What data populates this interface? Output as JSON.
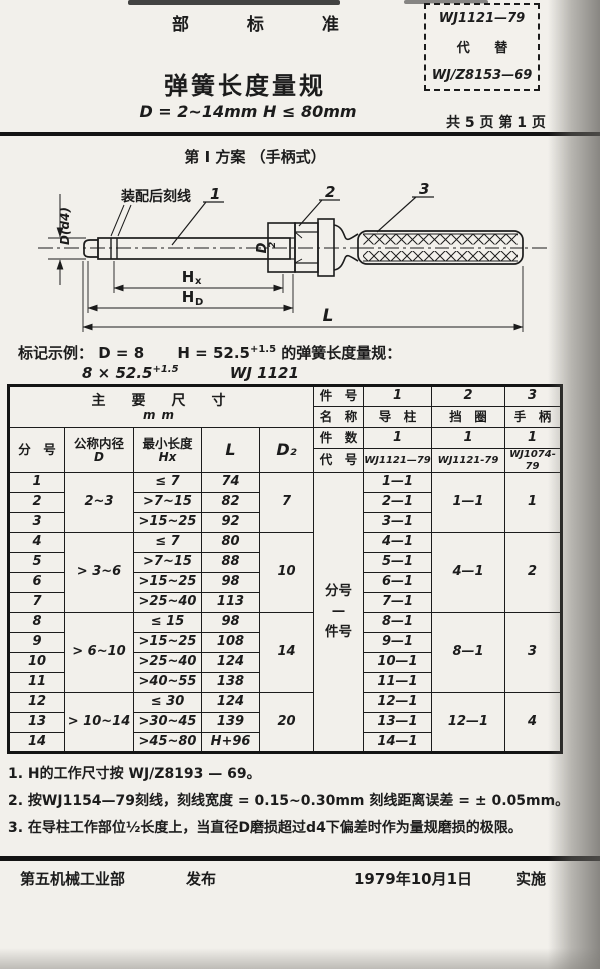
{
  "header": {
    "standard_type": "部 标 准",
    "code_box": {
      "line1": "WJ1121—79",
      "line2": "代 替",
      "line3": "WJ/Z8153—69"
    },
    "title": "弹簧长度量规",
    "spec_line": "D = 2~14mm   H ≤ 80mm",
    "page_info": "共 5 页 第 1 页"
  },
  "scheme_heading": "第 I 方案   （手柄式）",
  "drawing": {
    "scribe_callout": "装配后刻线",
    "part_labels": [
      "1",
      "2",
      "3"
    ],
    "dim_d": "D(d4)",
    "dim_d2_base": "D",
    "dim_d2_sub": "2",
    "dim_hx_base": "H",
    "dim_hx_sub": "x",
    "dim_hd_base": "H",
    "dim_hd_sub": "D",
    "dim_l": "L"
  },
  "marking": {
    "label": "标记示例：",
    "d": "D = 8",
    "h": "H = 52.5",
    "h_tol": "+1.5",
    "suffix": "的弹簧长度量规：",
    "line2": "8 × 52.5",
    "line2_tol": "+1.5",
    "code": "WJ 1121"
  },
  "table": {
    "header_rows": [
      [
        {
          "t": "主　要　尺　寸",
          "sub": "mm",
          "cs": 5,
          "rs": 2,
          "cls": "big"
        },
        {
          "t": "件　号",
          "cls": "hd2"
        },
        {
          "t": "1",
          "cls": "num"
        },
        {
          "t": "2",
          "cls": "num"
        },
        {
          "t": "3",
          "cls": "num"
        }
      ],
      [
        {
          "t": "名　称",
          "cls": "hd2"
        },
        {
          "t": "导　柱",
          "cls": "hd2"
        },
        {
          "t": "挡　圈",
          "cls": "hd2"
        },
        {
          "t": "手　柄",
          "cls": "hd2"
        }
      ],
      [
        {
          "t": "分　号",
          "rs": 2,
          "cls": "hd2"
        },
        {
          "t": "公称内径",
          "sub": "D",
          "rs": 2,
          "cls": "hd2"
        },
        {
          "t": "最小长度",
          "sub": "Hx",
          "rs": 2,
          "cls": "hd2"
        },
        {
          "t": "L",
          "rs": 2,
          "cls": "lat"
        },
        {
          "t": "D₂",
          "rs": 2,
          "cls": "lat"
        },
        {
          "t": "件　数",
          "cls": "hd2"
        },
        {
          "t": "1",
          "cls": "num"
        },
        {
          "t": "1",
          "cls": "num"
        },
        {
          "t": "1",
          "cls": "num"
        }
      ],
      [
        {
          "t": "代　号",
          "cls": "hd2"
        },
        {
          "t": "WJ1121—79",
          "cls": "code"
        },
        {
          "t": "WJ1121-79",
          "cls": "code"
        },
        {
          "t": "WJ1074-79",
          "cls": "code"
        }
      ]
    ],
    "body_rows": [
      [
        {
          "t": "1",
          "cls": "num"
        },
        {
          "t": "2~3",
          "rs": 3,
          "cls": "num"
        },
        {
          "t": "≤ 7",
          "cls": "num"
        },
        {
          "t": "74",
          "cls": "num"
        },
        {
          "t": "7",
          "rs": 3,
          "cls": "num"
        },
        {
          "lines": [
            "分号",
            "—",
            "件号"
          ],
          "rs": 14,
          "cls": "lbl"
        },
        {
          "t": "1—1",
          "cls": "num"
        },
        {
          "t": "1—1",
          "rs": 3,
          "cls": "num"
        },
        {
          "t": "1",
          "rs": 3,
          "cls": "num"
        }
      ],
      [
        {
          "t": "2",
          "cls": "num"
        },
        {
          "t": ">7~15",
          "cls": "num"
        },
        {
          "t": "82",
          "cls": "num"
        },
        {
          "t": "2—1",
          "cls": "num"
        }
      ],
      [
        {
          "t": "3",
          "cls": "num"
        },
        {
          "t": ">15~25",
          "cls": "num"
        },
        {
          "t": "92",
          "cls": "num"
        },
        {
          "t": "3—1",
          "cls": "num"
        }
      ],
      [
        {
          "t": "4",
          "cls": "num"
        },
        {
          "t": "> 3~6",
          "rs": 4,
          "cls": "num"
        },
        {
          "t": "≤ 7",
          "cls": "num"
        },
        {
          "t": "80",
          "cls": "num"
        },
        {
          "t": "10",
          "rs": 4,
          "cls": "num"
        },
        {
          "t": "4—1",
          "cls": "num"
        },
        {
          "t": "4—1",
          "rs": 4,
          "cls": "num"
        },
        {
          "t": "2",
          "rs": 4,
          "cls": "num"
        }
      ],
      [
        {
          "t": "5",
          "cls": "num"
        },
        {
          "t": ">7~15",
          "cls": "num"
        },
        {
          "t": "88",
          "cls": "num"
        },
        {
          "t": "5—1",
          "cls": "num"
        }
      ],
      [
        {
          "t": "6",
          "cls": "num"
        },
        {
          "t": ">15~25",
          "cls": "num"
        },
        {
          "t": "98",
          "cls": "num"
        },
        {
          "t": "6—1",
          "cls": "num"
        }
      ],
      [
        {
          "t": "7",
          "cls": "num"
        },
        {
          "t": ">25~40",
          "cls": "num"
        },
        {
          "t": "113",
          "cls": "num"
        },
        {
          "t": "7—1",
          "cls": "num"
        }
      ],
      [
        {
          "t": "8",
          "cls": "num"
        },
        {
          "t": "> 6~10",
          "rs": 4,
          "cls": "num"
        },
        {
          "t": "≤ 15",
          "cls": "num"
        },
        {
          "t": "98",
          "cls": "num"
        },
        {
          "t": "14",
          "rs": 4,
          "cls": "num"
        },
        {
          "t": "8—1",
          "cls": "num"
        },
        {
          "t": "8—1",
          "rs": 4,
          "cls": "num"
        },
        {
          "t": "3",
          "rs": 4,
          "cls": "num"
        }
      ],
      [
        {
          "t": "9",
          "cls": "num"
        },
        {
          "t": ">15~25",
          "cls": "num"
        },
        {
          "t": "108",
          "cls": "num"
        },
        {
          "t": "9—1",
          "cls": "num"
        }
      ],
      [
        {
          "t": "10",
          "cls": "num"
        },
        {
          "t": ">25~40",
          "cls": "num"
        },
        {
          "t": "124",
          "cls": "num"
        },
        {
          "t": "10—1",
          "cls": "num"
        }
      ],
      [
        {
          "t": "11",
          "cls": "num"
        },
        {
          "t": ">40~55",
          "cls": "num"
        },
        {
          "t": "138",
          "cls": "num"
        },
        {
          "t": "11—1",
          "cls": "num"
        }
      ],
      [
        {
          "t": "12",
          "cls": "num"
        },
        {
          "t": "> 10~14",
          "rs": 3,
          "cls": "num"
        },
        {
          "t": "≤ 30",
          "cls": "num"
        },
        {
          "t": "124",
          "cls": "num"
        },
        {
          "t": "20",
          "rs": 3,
          "cls": "num"
        },
        {
          "t": "12—1",
          "cls": "num"
        },
        {
          "t": "12—1",
          "rs": 3,
          "cls": "num"
        },
        {
          "t": "4",
          "rs": 3,
          "cls": "num"
        }
      ],
      [
        {
          "t": "13",
          "cls": "num"
        },
        {
          "t": ">30~45",
          "cls": "num"
        },
        {
          "t": "139",
          "cls": "num"
        },
        {
          "t": "13—1",
          "cls": "num"
        }
      ],
      [
        {
          "t": "14",
          "cls": "num"
        },
        {
          "t": ">45~80",
          "cls": "num"
        },
        {
          "t": "H+96",
          "cls": "num"
        },
        {
          "t": "14—1",
          "cls": "num"
        }
      ]
    ]
  },
  "notes": [
    "1. H的工作尺寸按 WJ/Z8193 — 69。",
    "2. 按WJ1154—79刻线，刻线宽度 = 0.15~0.30mm 刻线距离误差 = ± 0.05mm。",
    "3. 在导柱工作部位½长度上，当直径D磨损超过d4下偏差时作为量规磨损的极限。"
  ],
  "footer": {
    "issuer": "第五机械工业部",
    "issue_word": "发布",
    "date": "1979年10月1日",
    "impl_word": "实施"
  }
}
